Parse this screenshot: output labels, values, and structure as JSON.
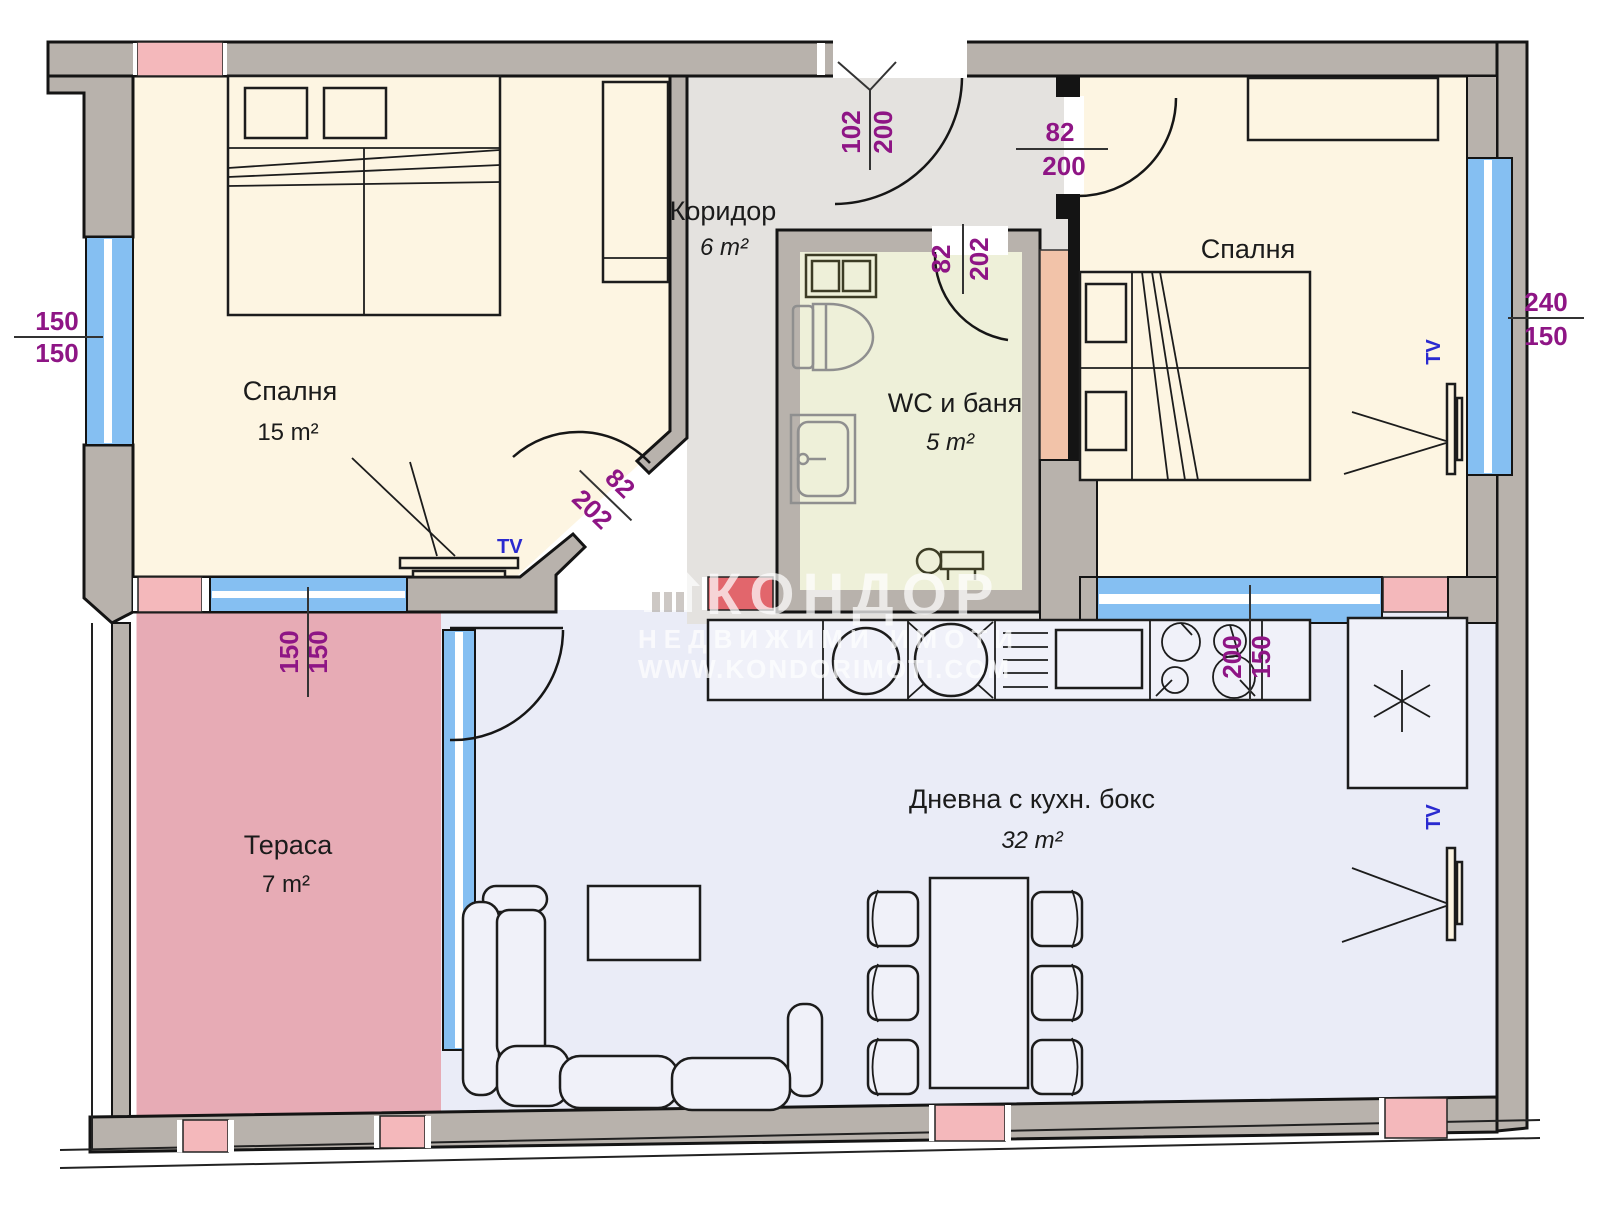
{
  "title": "apartment-floor-plan",
  "rooms": {
    "bedroom_left": {
      "name": "Спалня",
      "area": "15 m²"
    },
    "bedroom_right": {
      "name": "Спалня"
    },
    "corridor": {
      "name": "Коридор",
      "area": "6 m²"
    },
    "bathroom": {
      "name": "WC и баня",
      "area": "5 m²"
    },
    "living": {
      "name": "Дневна с кухн. бокс",
      "area": "32 m²"
    },
    "terrace": {
      "name": "Тераса",
      "area": "7 m²"
    }
  },
  "dimensions": {
    "left_window": {
      "a": "150",
      "b": "150"
    },
    "terrace_window": {
      "a": "150",
      "b": "150"
    },
    "entrance_door": {
      "a": "102",
      "b": "200"
    },
    "bedroom_right_door": {
      "a": "82",
      "b": "200"
    },
    "bathroom_door": {
      "a": "82",
      "b": "202"
    },
    "bedroom_left_door": {
      "a": "82",
      "b": "202"
    },
    "kitchen_window": {
      "a": "200",
      "b": "150"
    },
    "right_window": {
      "a": "240",
      "b": "150"
    }
  },
  "labels": {
    "tv": "TV"
  },
  "watermark": {
    "brand": "КОНДОР",
    "line2": "НЕДВИЖИМИ ИМОТИ",
    "line3": "WWW.KONDORIMOTI.COM"
  },
  "colors": {
    "wall": "#b8b2ac",
    "floor_bedroom": "#fdf5e2",
    "floor_corridor": "#e4e2df",
    "floor_bathroom": "#eef0d9",
    "floor_living": "#eaecf7",
    "terrace": "#e7abb5",
    "window": "#85bff2",
    "pink_block": "#f4b8bb",
    "red_block": "#e2666c",
    "shaft": "#f2c3a9",
    "dimension_text": "#8e1585",
    "tv_text": "#2a2ad0"
  }
}
